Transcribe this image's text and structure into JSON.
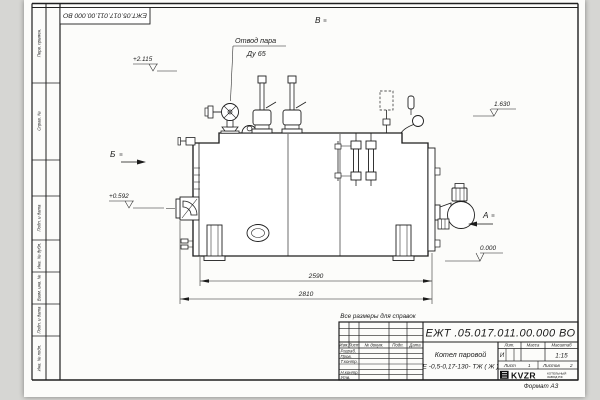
{
  "page": {
    "format_note": "Формат А3"
  },
  "frame": {
    "top_left_designation": "ЕЖТ.05.017.011.00.000  ВО",
    "margin_labels": [
      "Перв. примен.",
      "Справ. №",
      "Подп. и дата",
      "Инв. № дубл.",
      "Взам. инв. №",
      "Подп. и дата",
      "Инв. № подл."
    ]
  },
  "drawing": {
    "callout": {
      "line1": "Отвод пара",
      "line2": "Ду 65"
    },
    "views": {
      "top": "В",
      "left": "Б",
      "right": "А"
    },
    "elevations": {
      "valve_top": "+2.115",
      "burner_axis": "+0.592",
      "rear_top": "1.630",
      "base": "0.000"
    },
    "dimensions": {
      "body_length": "2590",
      "overall_length": "2810"
    }
  },
  "title_block": {
    "note": "Все размеры для справок",
    "designation": "ЕЖТ .05.017.011.00.000  ВО",
    "product_name_line1": "Котел паровой",
    "product_name_line2": "Е -0,5-0,17-130- ТЖ ( Ж )",
    "columns": [
      "Изм.",
      "Лист",
      "№ докум.",
      "Подп.",
      "Дата"
    ],
    "rows": [
      "Разраб.",
      "Пров.",
      "Т.контр.",
      "",
      "Н.контр.",
      "Утв."
    ],
    "lit_header": "Лит.",
    "mass_header": "Масса",
    "scale_header": "Масштаб",
    "lit_value": "И",
    "scale_value": "1:15",
    "sheet_label": "Лист",
    "sheet_value": "1",
    "sheets_label": "Листов",
    "sheets_value": "2",
    "logo": {
      "text": "KVZR",
      "sub1": "КОТЕЛЬНЫЙ",
      "sub2": "ЗАВОД РФ"
    }
  }
}
